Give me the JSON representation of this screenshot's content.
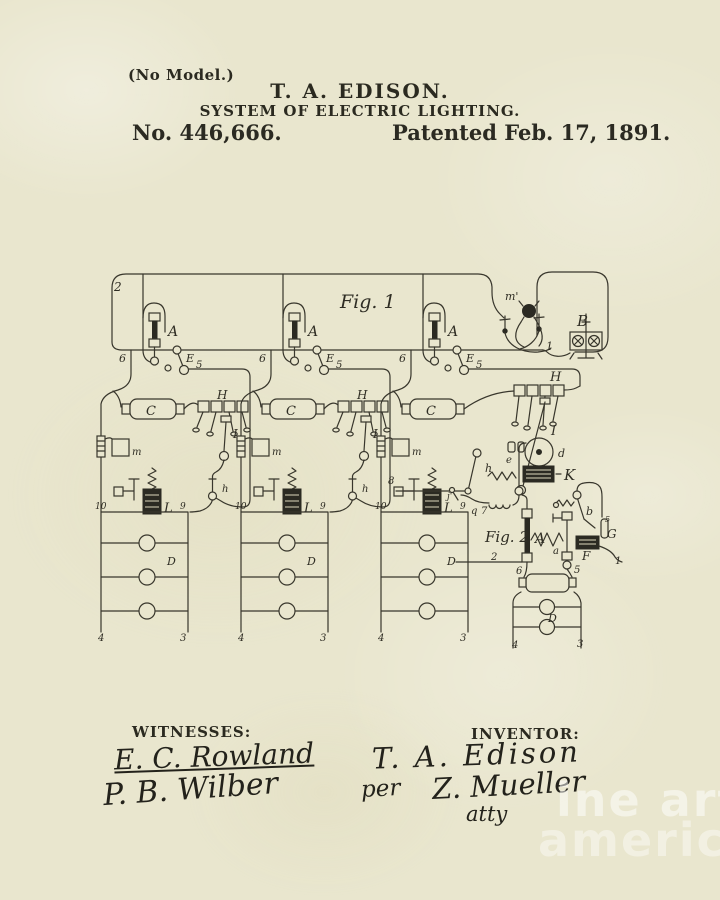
{
  "page": {
    "header": {
      "no_model": "(No Model.)",
      "inventor_name": "T. A. EDISON.",
      "title": "SYSTEM OF ELECTRIC LIGHTING.",
      "patent_number": "No. 446,666.",
      "patent_date": "Patented Feb. 17, 1891."
    },
    "footer": {
      "witnesses_label": "WITNESSES:",
      "witness_signature_1": "E. C. Rowland",
      "witness_signature_2": "P. B. Wilber",
      "inventor_label": "INVENTOR:",
      "inventor_signature": "T. A. Edison",
      "per": "per",
      "attorney_signature": "Z. Mueller",
      "attorney_title": "atty"
    },
    "watermark": {
      "line1": "ine art",
      "line2": "america"
    },
    "colors": {
      "paper": "#e9e6ce",
      "ink": "#2b2a22",
      "watermark": "rgba(255,255,255,0.5)"
    }
  },
  "diagram": {
    "labels": [
      {
        "t": "2",
        "x": 114,
        "y": 291,
        "fs": 12
      },
      {
        "t": "Fig. 1",
        "x": 340,
        "y": 308,
        "fs": 19
      },
      {
        "t": "m'",
        "x": 505,
        "y": 300,
        "fs": 11
      },
      {
        "t": "B",
        "x": 577,
        "y": 326,
        "fs": 15
      },
      {
        "t": "1",
        "x": 546,
        "y": 350,
        "fs": 11
      },
      {
        "t": "H",
        "x": 550,
        "y": 381,
        "fs": 13
      },
      {
        "t": "I",
        "x": 551,
        "y": 435,
        "fs": 13
      },
      {
        "t": "d",
        "x": 558,
        "y": 457,
        "fs": 11
      },
      {
        "t": "e",
        "x": 506,
        "y": 463,
        "fs": 10
      },
      {
        "t": "K",
        "x": 564,
        "y": 480,
        "fs": 15
      },
      {
        "t": "h",
        "x": 485,
        "y": 472,
        "fs": 11
      },
      {
        "t": "j'",
        "x": 447,
        "y": 499,
        "fs": 9
      },
      {
        "t": "q",
        "x": 471,
        "y": 514,
        "fs": 10
      },
      {
        "t": "7",
        "x": 481,
        "y": 514,
        "fs": 10
      },
      {
        "t": "8",
        "x": 388,
        "y": 484,
        "fs": 10
      },
      {
        "t": "Fig. 2",
        "x": 485,
        "y": 542,
        "fs": 15
      },
      {
        "t": "A",
        "x": 535,
        "y": 543,
        "fs": 14
      },
      {
        "t": "a",
        "x": 553,
        "y": 554,
        "fs": 10
      },
      {
        "t": "b",
        "x": 586,
        "y": 515,
        "fs": 11
      },
      {
        "t": "G",
        "x": 607,
        "y": 538,
        "fs": 12
      },
      {
        "t": "5",
        "x": 605,
        "y": 522,
        "fs": 8
      },
      {
        "t": "F",
        "x": 582,
        "y": 560,
        "fs": 12
      },
      {
        "t": "1",
        "x": 615,
        "y": 564,
        "fs": 10
      },
      {
        "t": "2",
        "x": 491,
        "y": 560,
        "fs": 10
      },
      {
        "t": "6",
        "x": 516,
        "y": 574,
        "fs": 10
      },
      {
        "t": "5",
        "x": 574,
        "y": 573,
        "fs": 10
      },
      {
        "t": "D",
        "x": 548,
        "y": 622,
        "fs": 11
      },
      {
        "t": "4",
        "x": 512,
        "y": 648,
        "fs": 10
      },
      {
        "t": "3",
        "x": 577,
        "y": 647,
        "fs": 10
      },
      {
        "t": "A",
        "x": 168,
        "y": 336,
        "fs": 14
      },
      {
        "t": "E",
        "x": 186,
        "y": 362,
        "fs": 11
      },
      {
        "t": "5",
        "x": 196,
        "y": 368,
        "fs": 10
      },
      {
        "t": "6",
        "x": 119,
        "y": 362,
        "fs": 11
      },
      {
        "t": "C",
        "x": 146,
        "y": 415,
        "fs": 13
      },
      {
        "t": "m",
        "x": 132,
        "y": 455,
        "fs": 10
      },
      {
        "t": "L",
        "x": 164,
        "y": 512,
        "fs": 13
      },
      {
        "t": "10",
        "x": 95,
        "y": 509,
        "fs": 9
      },
      {
        "t": "9",
        "x": 180,
        "y": 509,
        "fs": 9
      },
      {
        "t": "D",
        "x": 167,
        "y": 565,
        "fs": 11
      },
      {
        "t": "4",
        "x": 98,
        "y": 641,
        "fs": 10
      },
      {
        "t": "3",
        "x": 180,
        "y": 641,
        "fs": 10
      },
      {
        "t": "H",
        "x": 217,
        "y": 399,
        "fs": 12
      },
      {
        "t": "I",
        "x": 233,
        "y": 438,
        "fs": 12
      },
      {
        "t": "h",
        "x": 222,
        "y": 492,
        "fs": 10
      },
      {
        "t": "A",
        "x": 308,
        "y": 336,
        "fs": 14
      },
      {
        "t": "E",
        "x": 326,
        "y": 362,
        "fs": 11
      },
      {
        "t": "5",
        "x": 336,
        "y": 368,
        "fs": 10
      },
      {
        "t": "6",
        "x": 259,
        "y": 362,
        "fs": 11
      },
      {
        "t": "C",
        "x": 286,
        "y": 415,
        "fs": 13
      },
      {
        "t": "m",
        "x": 272,
        "y": 455,
        "fs": 10
      },
      {
        "t": "L",
        "x": 304,
        "y": 512,
        "fs": 13
      },
      {
        "t": "10",
        "x": 235,
        "y": 509,
        "fs": 9
      },
      {
        "t": "9",
        "x": 320,
        "y": 509,
        "fs": 9
      },
      {
        "t": "D",
        "x": 307,
        "y": 565,
        "fs": 11
      },
      {
        "t": "4",
        "x": 238,
        "y": 641,
        "fs": 10
      },
      {
        "t": "3",
        "x": 320,
        "y": 641,
        "fs": 10
      },
      {
        "t": "H",
        "x": 357,
        "y": 399,
        "fs": 12
      },
      {
        "t": "I",
        "x": 373,
        "y": 438,
        "fs": 12
      },
      {
        "t": "h",
        "x": 362,
        "y": 492,
        "fs": 10
      },
      {
        "t": "A",
        "x": 448,
        "y": 336,
        "fs": 14
      },
      {
        "t": "E",
        "x": 466,
        "y": 362,
        "fs": 11
      },
      {
        "t": "5",
        "x": 476,
        "y": 368,
        "fs": 10
      },
      {
        "t": "6",
        "x": 399,
        "y": 362,
        "fs": 11
      },
      {
        "t": "C",
        "x": 426,
        "y": 415,
        "fs": 13
      },
      {
        "t": "m",
        "x": 412,
        "y": 455,
        "fs": 10
      },
      {
        "t": "L",
        "x": 444,
        "y": 512,
        "fs": 13
      },
      {
        "t": "10",
        "x": 375,
        "y": 509,
        "fs": 9
      },
      {
        "t": "9",
        "x": 460,
        "y": 509,
        "fs": 9
      },
      {
        "t": "D",
        "x": 447,
        "y": 565,
        "fs": 11
      },
      {
        "t": "4",
        "x": 378,
        "y": 641,
        "fs": 10
      },
      {
        "t": "3",
        "x": 460,
        "y": 641,
        "fs": 10
      }
    ]
  }
}
